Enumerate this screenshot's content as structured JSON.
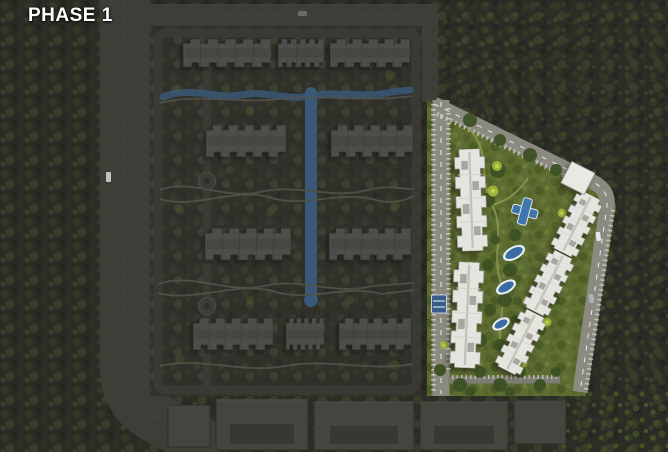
{
  "page": {
    "phase_label": "PHASE 1"
  },
  "map": {
    "highlighted_region": "phase-1-parcel",
    "colors": {
      "label_text": "#ffffff",
      "dim_terrain": "#2b2c25",
      "compound_terrain": "#30312a",
      "dark_road": "#3e3e39",
      "dark_building": "#4e4e49",
      "highlight_lawn": "#5d6c31",
      "bright_road": "#8a8a81",
      "white_building": "#e5e5df",
      "pool_blue": "#3f74ad",
      "canal_blue": "#3a5878",
      "bright_tree": "#9cb13b"
    }
  }
}
